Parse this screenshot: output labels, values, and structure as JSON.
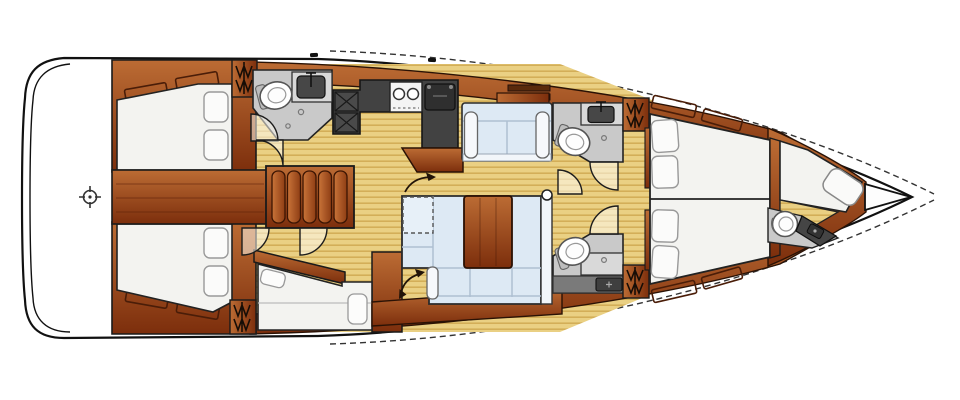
{
  "image": {
    "type": "sailboat-interior-floor-plan",
    "orientation": "bow-right",
    "width": 960,
    "height": 400
  },
  "palette": {
    "background": "#ffffff",
    "outline": "#1a1a1a",
    "hullStroke": "#111111",
    "woodLight": "#bc6c34",
    "woodMid": "#a34e1e",
    "woodDark": "#7c2e0c",
    "woodGroove": "#5a2208",
    "treadLight": "#c97439",
    "treadDark": "#8e3d14",
    "teakBase": "#ead083",
    "teakStripe": "#d3ae58",
    "counterDark": "#424242",
    "fixtureDark": "#474747",
    "counterLight": "#d8d8d8",
    "floorGray": "#c9c9c9",
    "grayBand": "#7a7a7a",
    "settee": "#dde9f4",
    "setteeLight": "#e9f1f9",
    "setteeTrim": "#f2f6fa",
    "berth": "#f3f3f0",
    "pillow": "#fbfbfa",
    "doorLeaf": "rgba(253,249,238,0.55)",
    "arrow": "#221408",
    "white": "#fdfdfd"
  },
  "rooms": [
    {
      "id": "stern-platform",
      "label": "stern platform",
      "fixtures": [
        "helm-crosshair"
      ]
    },
    {
      "id": "aft-cabin-port",
      "label": "aft double cabin port",
      "fixtures": [
        "double-berth",
        "pillow x2",
        "shelf x2",
        "wardrobe"
      ]
    },
    {
      "id": "aft-cabin-starboard",
      "label": "aft double cabin starboard",
      "fixtures": [
        "double-berth",
        "pillow x2",
        "shelf x2",
        "wardrobe"
      ]
    },
    {
      "id": "aft-head",
      "label": "aft head",
      "fixtures": [
        "toilet",
        "sink",
        "door x2"
      ]
    },
    {
      "id": "companionway",
      "label": "companionway steps",
      "fixtures": [
        "tread x5"
      ]
    },
    {
      "id": "galley",
      "label": "galley",
      "fixtures": [
        "stove-2-burner",
        "sink",
        "locker x2",
        "wood-counter"
      ]
    },
    {
      "id": "salon",
      "label": "salon",
      "fixtures": [
        "forward-settee",
        "u-settee",
        "table",
        "convertible-dashed-section",
        "swing-arrow x2",
        "knob"
      ]
    },
    {
      "id": "midship-head-port",
      "label": "midship head port",
      "fixtures": [
        "toilet",
        "sink",
        "wardrobe",
        "door"
      ]
    },
    {
      "id": "midship-head-starboard",
      "label": "midship head starboard",
      "fixtures": [
        "toilet",
        "sink",
        "wardrobe",
        "door",
        "drawer-unit"
      ]
    },
    {
      "id": "bunk-cabin",
      "label": "single bunk cabin",
      "fixtures": [
        "single-berth",
        "pillow x2",
        "wardrobe",
        "door x2"
      ]
    },
    {
      "id": "forward-cabin",
      "label": "forward twin cabin",
      "fixtures": [
        "twin-berths",
        "pillow x4",
        "shelf x4"
      ]
    },
    {
      "id": "bow-cabin",
      "label": "bow crew cabin / head",
      "fixtures": [
        "berth-pad",
        "toilet",
        "counter",
        "teak-floor"
      ]
    },
    {
      "id": "anchor-locker",
      "label": "anchor locker",
      "fixtures": []
    }
  ]
}
